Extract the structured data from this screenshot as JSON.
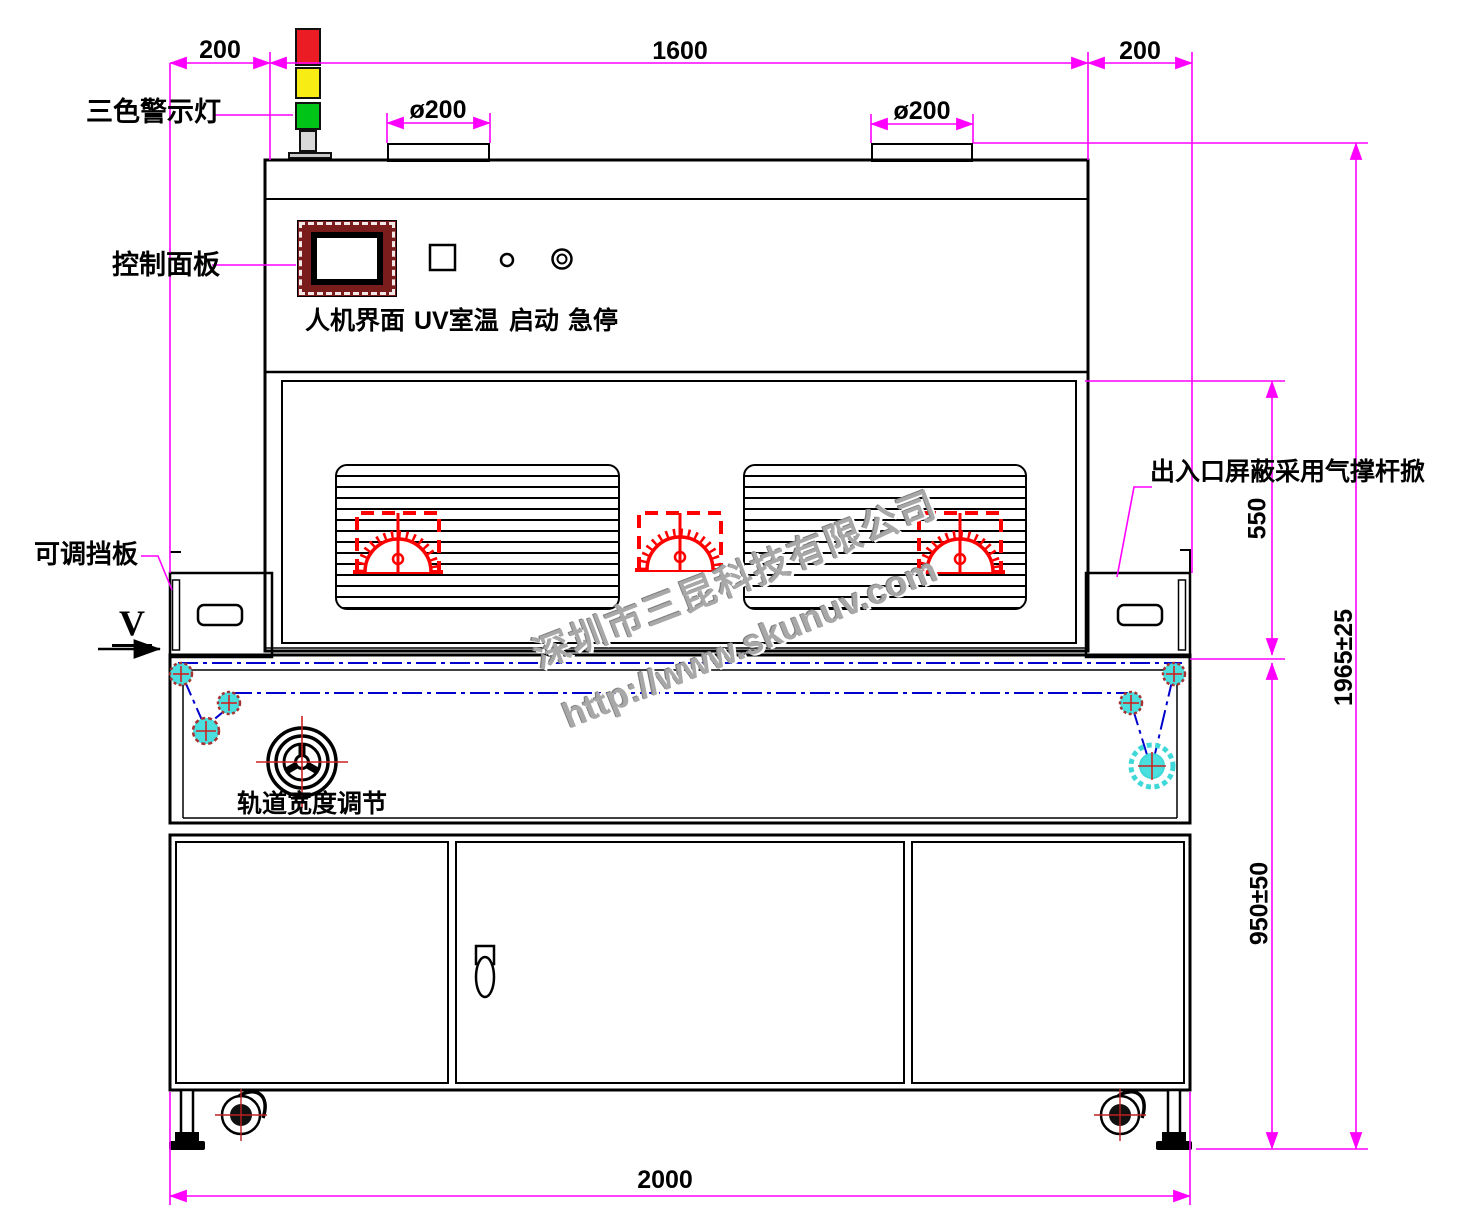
{
  "drawing": {
    "machine_labels": {
      "tower_light": "三色警示灯",
      "control_panel": "控制面板",
      "hmi": "人机界面",
      "uv_room_temp": "UV室温",
      "start": "启动",
      "emergency_stop": "急停",
      "adjustable_baffle": "可调挡板",
      "gas_strut_note": "出入口屏蔽采用气撑杆掀",
      "track_width_adjust": "轨道宽度调节",
      "view_marker": "V"
    },
    "dimensions": {
      "top_left": "200",
      "top_span": "1600",
      "top_right": "200",
      "duct_left_dia": "ø200",
      "duct_right_dia": "ø200",
      "chamber_height": "550",
      "table_height": "950±50",
      "total_height": "1965±25",
      "base_width": "2000"
    },
    "watermark": {
      "company": "深圳市三昆科技有限公司",
      "url": "http://www.skunuv.com"
    },
    "colors": {
      "dimension": "#FF00FF",
      "lamp": "#FF0000",
      "belt": "#0000CC",
      "roller": "#4ADEDE",
      "warning_red": "#EC1C24",
      "warning_yellow": "#F7EC13",
      "warning_green": "#00C418"
    }
  }
}
